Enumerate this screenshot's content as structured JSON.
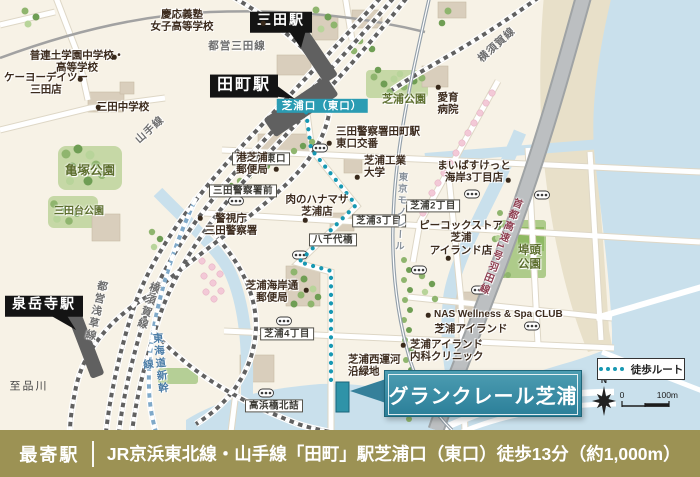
{
  "map": {
    "stations": {
      "mita": "三田駅",
      "tamachi": "田町駅",
      "sengakuji": "泉岳寺駅"
    },
    "exit_badge": "芝浦口（東口）",
    "crossings": {
      "tamachi_east": "田町駅東口",
      "mita_police_front": "三田警察署前",
      "yachiyo_bashi": "八千代橋",
      "shibaura3": "芝浦3丁目",
      "shibaura2": "芝浦2丁目",
      "shibaura4": "芝浦4丁目",
      "takahama": "高浜橋北詰"
    },
    "pois": {
      "keio": "慶応義塾\n女子高等学校",
      "furendo": "普連土学園中学校・\n高等学校",
      "keiyo": "ケーヨーデイツー\n三田店",
      "mita_jhs": "三田中学校",
      "mita_police": "警視庁\n三田警察署",
      "minato_post": "港芝浦\n郵便局",
      "koban": "三田警察署田町駅\n東口交番",
      "aiiku": "愛育\n病院",
      "sit_univ": "芝浦工業\n大学",
      "hanamasa": "肉のハナマサ\n芝浦店",
      "maibasket": "まいばすけっと\n海岸3丁目店",
      "peacock": "ピーコックストア\n芝浦\nアイランド店",
      "nas": "NAS Wellness & Spa CLUB",
      "island_clinic": "芝浦アイランド\n内科クリニック",
      "kaigan_post": "芝浦海岸通\n郵便局",
      "island_area": "芝浦アイランド",
      "ryokuchi": "芝浦西運河\n沿緑地"
    },
    "parks": {
      "kamezuka": "亀塚公園",
      "mitadai": "三田台公園",
      "shibaura": "芝浦公園",
      "futo": "埠頭\n公園"
    },
    "rails": {
      "mita_line": "都営三田線",
      "yamanote": "山手線",
      "asakusa": "都営浅草線",
      "yokosuka_top": "横須賀線",
      "yokosuka_left": "横須賀線",
      "shinkansen": "東海道新幹線",
      "monorail": "東京モノレール",
      "shuto": "首都高速1号羽田線"
    },
    "misc": {
      "to_shinagawa": "至品川",
      "compass_n": "N",
      "scale_zero": "0",
      "scale_hundred": "100m"
    },
    "legend": {
      "walk_route": "徒歩ルート"
    },
    "property": {
      "banner": "グランクレール芝浦"
    }
  },
  "footer": {
    "nearest_label": "最寄駅",
    "access_text": "JR京浜東北線・山手線「田町」駅芝浦口（東口）徒歩13分（約1,000m）"
  },
  "colors": {
    "route_teal": "#1798b2",
    "water": "#c9e0ec",
    "park_green": "#c6d8a6",
    "station_box": "#141414",
    "exit_badge": "#2b9cb3",
    "banner_teal": "#35809a",
    "footer_olive": "#9c9254",
    "shinkansen_blue": "#4a7ca6",
    "highway_label": "#8e3e50"
  }
}
